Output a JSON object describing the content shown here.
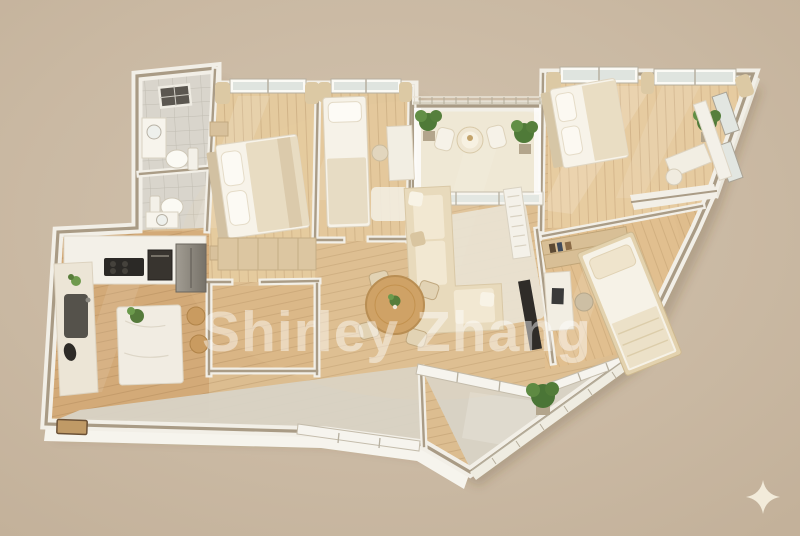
{
  "canvas": {
    "width": 800,
    "height": 536,
    "background_color": "#cab9a3"
  },
  "watermark": {
    "text": "Shirley Zhang",
    "color": "#ffffff",
    "opacity": "0.45"
  },
  "sparkle": {
    "color": "#f2ebda"
  },
  "palette": {
    "wall": "#f2efe7",
    "wall_cap": "#a99b85",
    "wood_hall": "#dcbd90",
    "wood_bedroom": "#e4ca9e",
    "wood_kitchen": "#d3aa78",
    "bathroom_tile": "#d9d5cc",
    "balcony_floor": "#d8d2c4",
    "entry_stone": "#d8d3c6",
    "sofa_fabric": "#e8dabc",
    "bedding_white": "#f7f3e9",
    "plant_green": "#55793b",
    "appliance_dark": "#2f2c28",
    "dining_table_wood": "#cfa266"
  }
}
